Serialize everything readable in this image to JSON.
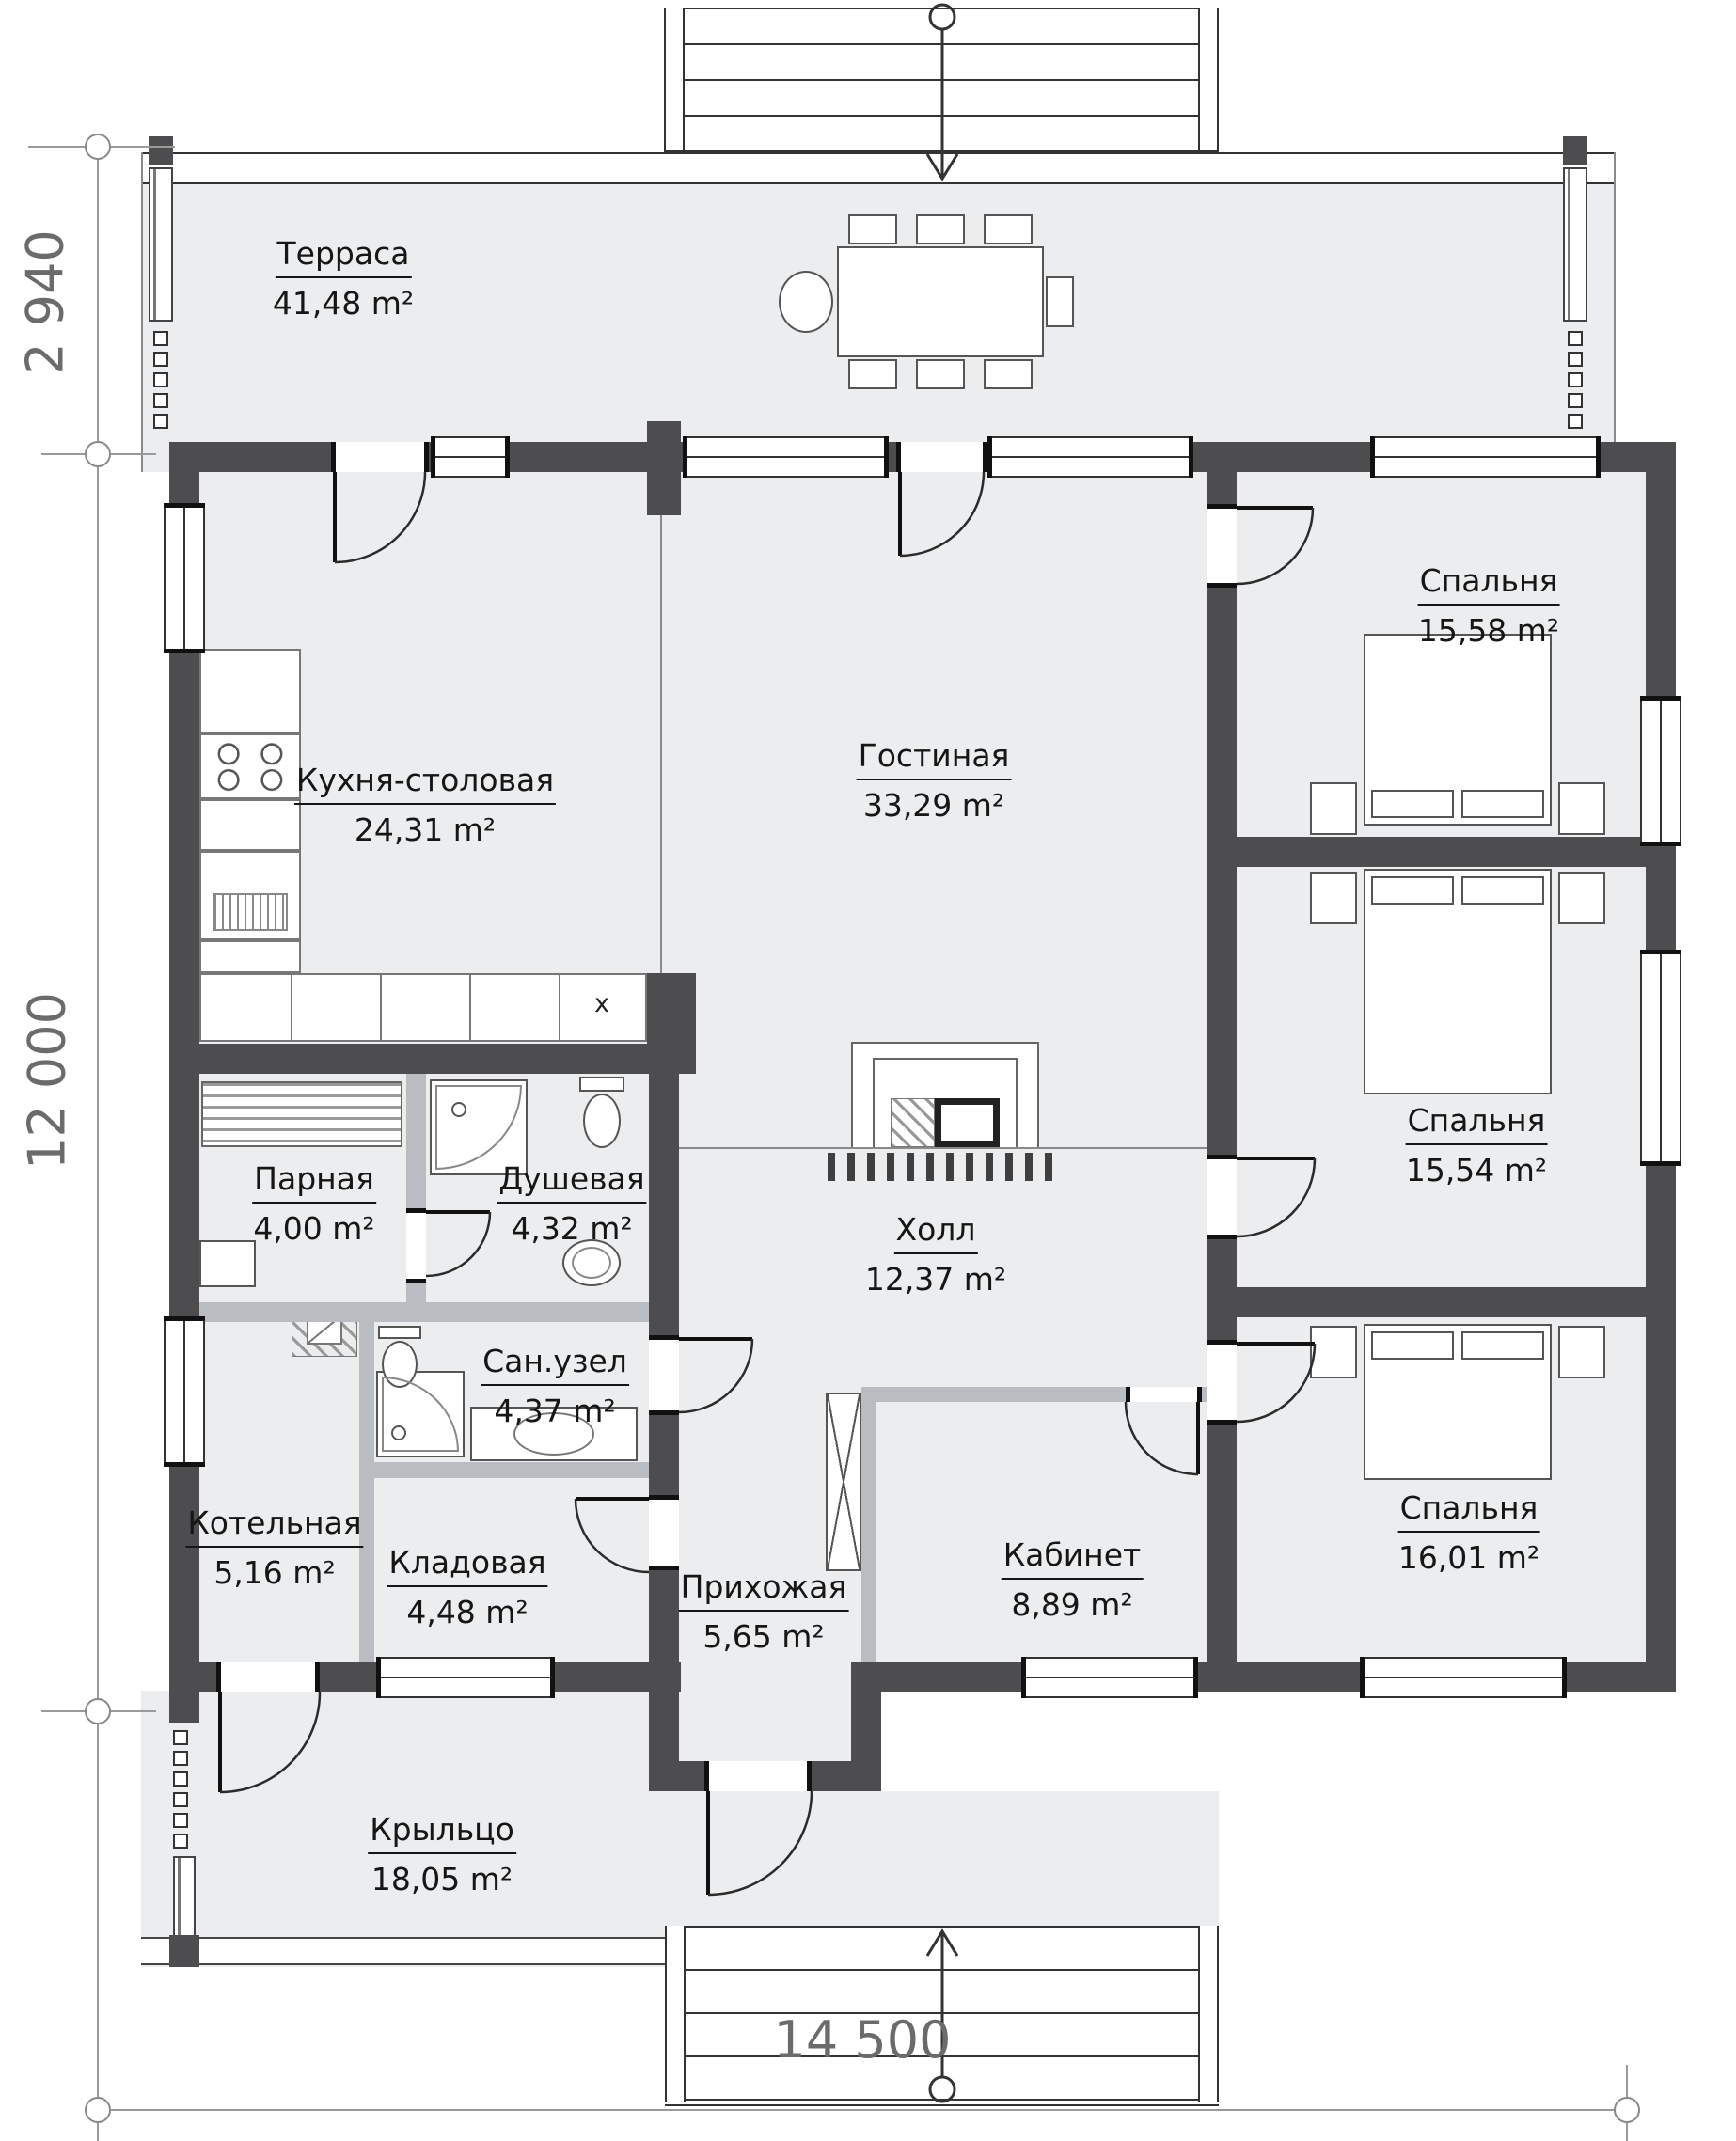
{
  "plan": {
    "type": "floor-plan",
    "language": "ru",
    "rooms": [
      {
        "name": "Терраса",
        "area": "41,48 m²"
      },
      {
        "name": "Кухня-столовая",
        "area": "24,31 m²"
      },
      {
        "name": "Гостиная",
        "area": "33,29 m²"
      },
      {
        "name": "Спальня",
        "area": "15,58 m²"
      },
      {
        "name": "Парная",
        "area": "4,00 m²"
      },
      {
        "name": "Душевая",
        "area": "4,32 m²"
      },
      {
        "name": "Холл",
        "area": "12,37 m²"
      },
      {
        "name": "Спальня",
        "area": "15,54 m²"
      },
      {
        "name": "Сан.узел",
        "area": "4,37 m²"
      },
      {
        "name": "Котельная",
        "area": "5,16 m²"
      },
      {
        "name": "Кладовая",
        "area": "4,48 m²"
      },
      {
        "name": "Прихожая",
        "area": "5,65 m²"
      },
      {
        "name": "Кабинет",
        "area": "8,89 m²"
      },
      {
        "name": "Спальня",
        "area": "16,01 m²"
      },
      {
        "name": "Крыльцо",
        "area": "18,05 m²"
      }
    ],
    "dimensions": {
      "left_top": "2 940",
      "left_side": "12 000",
      "bottom": "14 500"
    },
    "marks": {
      "kitchen_sink": "x"
    },
    "colors": {
      "wall": "#4d4d4f",
      "partition": "#b9bcc0",
      "floor": "#ebedef",
      "text": "#161616",
      "dimension_text": "#6b6b6b"
    }
  }
}
